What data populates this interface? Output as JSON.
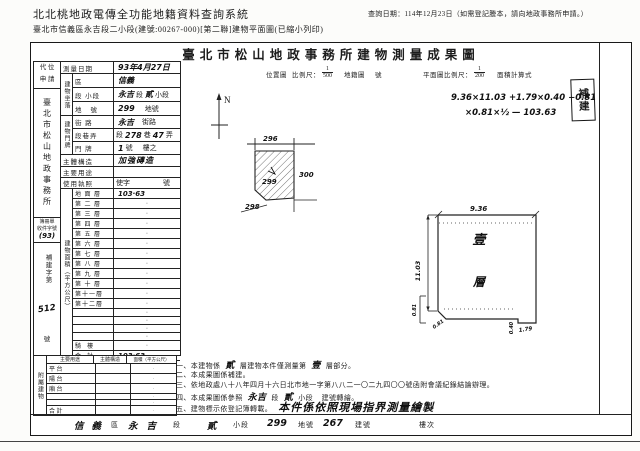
{
  "page_header": {
    "system_title": "北北桃地政電傳全功能地籍資料查詢系統",
    "query_date": "查詢日期：114年12月23日（如需登記謄本，請向地政事務所申請。）",
    "doc_line": "臺北市信義區永吉段二小段(建號:00267-000)[第二聯]建物平面圖(已縮小列印)"
  },
  "title": "臺北市松山地政事務所建物測量成果圖",
  "stamp": "補建",
  "map_header": {
    "loc_label": "位置圖",
    "scale_label": "比例尺：",
    "scale_num": "1",
    "scale_den": "500",
    "cadastral_label": "地籍圖",
    "cadastral_no": "號",
    "plan_scale_label": "平面圖比例尺：",
    "plan_scale_num": "1",
    "plan_scale_den": "200",
    "area_calc_label": "面積計算式"
  },
  "calc": {
    "line1": "9.36×11.03 +1.79×0.40 −0.81",
    "line2": "×0.81×½ — 103.63"
  },
  "north": "N",
  "loc_map": {
    "top_lot": "296",
    "right_lot": "300",
    "bottom_lot": "298",
    "subject_lot": "299"
  },
  "plan": {
    "top_dim": "9.36",
    "left_dim": "11.03",
    "cut_dim_side": "0.81",
    "cut_dim_diag": "0.81",
    "tab_dim_w": "1.79",
    "tab_dim_h": "0.40",
    "floor_char_1": "壹",
    "floor_char_2": "層"
  },
  "sidebar": {
    "daiwei_1": "代 位",
    "daiwei_2": "申 請",
    "office": "臺北市松山地政事務所",
    "book_label_1": "簿冊單",
    "book_label_2": "收件字號",
    "book_no": "(93)",
    "case_prefix": "補建字第",
    "case_no": "512",
    "case_suffix": "號",
    "attached_label": "附屬建物"
  },
  "fields": {
    "survey_date_label": "測量日期",
    "survey_date": "93年4月27日",
    "zuoluo_group": "建物坐落",
    "district_label": "區",
    "district": "信義",
    "section_label": "段 小段",
    "section_hw1": "永吉",
    "section_p1": "段",
    "section_hw2": "貳",
    "section_p2": "小段",
    "lot_label": "地   號",
    "lot_no": "299",
    "lot_suffix": "地號",
    "menpai_group": "建物門牌",
    "street_label": "街 路",
    "street": "永吉",
    "street_suffix": "街路",
    "lane_label": "段巷弄",
    "lane_p1": "段",
    "lane_hw1": "278",
    "lane_p2": "巷",
    "lane_hw2": "47",
    "lane_p3": "弄",
    "door_label": "門 牌",
    "door_hw": "1",
    "door_p1": "號",
    "door_p2": "樓之",
    "structure_label": "主體構造",
    "structure": "加強磚造",
    "use_label": "主要用途",
    "use_value": "",
    "license_label": "使用執照",
    "license_p1": "使字",
    "license_p2": "號"
  },
  "floor_area": {
    "group_label": "建物面積（平方公尺）",
    "rows": [
      {
        "label": "地 面 層",
        "value": "103·63"
      },
      {
        "label": "第 二 層",
        "value": "·"
      },
      {
        "label": "第 三 層",
        "value": "·"
      },
      {
        "label": "第 四 層",
        "value": "·"
      },
      {
        "label": "第 五 層",
        "value": "·"
      },
      {
        "label": "第 六 層",
        "value": "·"
      },
      {
        "label": "第 七 層",
        "value": "·"
      },
      {
        "label": "第 八 層",
        "value": "·"
      },
      {
        "label": "第 九 層",
        "value": "·"
      },
      {
        "label": "第 十 層",
        "value": "·"
      },
      {
        "label": "第十一層",
        "value": "·"
      },
      {
        "label": "第十二層",
        "value": "·"
      },
      {
        "label": "",
        "value": "·"
      },
      {
        "label": "",
        "value": "·"
      },
      {
        "label": "",
        "value": "·"
      },
      {
        "label": "",
        "value": "·"
      },
      {
        "label": "騎  樓",
        "value": "·"
      },
      {
        "label": "合  計",
        "value": "103·63"
      }
    ]
  },
  "attached_table": {
    "headers": {
      "use": "主要用途",
      "structure": "主體構造",
      "area": "面積（平方公尺）"
    },
    "rows": [
      {
        "use": "平 台",
        "structure": "",
        "area": "·"
      },
      {
        "use": "陽 台",
        "structure": "",
        "area": "·"
      },
      {
        "use": "廂 台",
        "structure": "",
        "area": "·"
      },
      {
        "use": "",
        "structure": "",
        "area": "·"
      },
      {
        "use": "",
        "structure": "",
        "area": "·"
      },
      {
        "use": "合 計",
        "structure": "",
        "area": "·"
      }
    ]
  },
  "notes": {
    "l1_pre": "一、本建物係",
    "l1_hw1": "貳",
    "l1_mid": "層建物本件僅測量第",
    "l1_hw2": "壹",
    "l1_post": "層部分。",
    "l2": "二、本成果圖係補建。",
    "l3": "三、依地政處八十八年四月十六日北市地一字第八八二一〇二九四〇〇號函附會議紀錄結論辦理。",
    "l4_pre": "四、本成果圖係參照",
    "l4_hw1": "永吉",
    "l4_mid": "段",
    "l4_hw2": "貳",
    "l4_post": "小段    建號轉繪。",
    "l5_pre": "五、建物標示依登記簿轉載。",
    "l5_hw": "本件係依照現場指界測量繪製"
  },
  "footer": {
    "district_hw": "信義",
    "district_label": "區",
    "section_hw": "永吉",
    "section_label": "段",
    "subsection_hw": "貳",
    "subsection_label": "小段",
    "lot_hw": "299",
    "lot_label": "地號",
    "building_hw": "267",
    "building_label": "建號",
    "floor_label": "樓次"
  }
}
